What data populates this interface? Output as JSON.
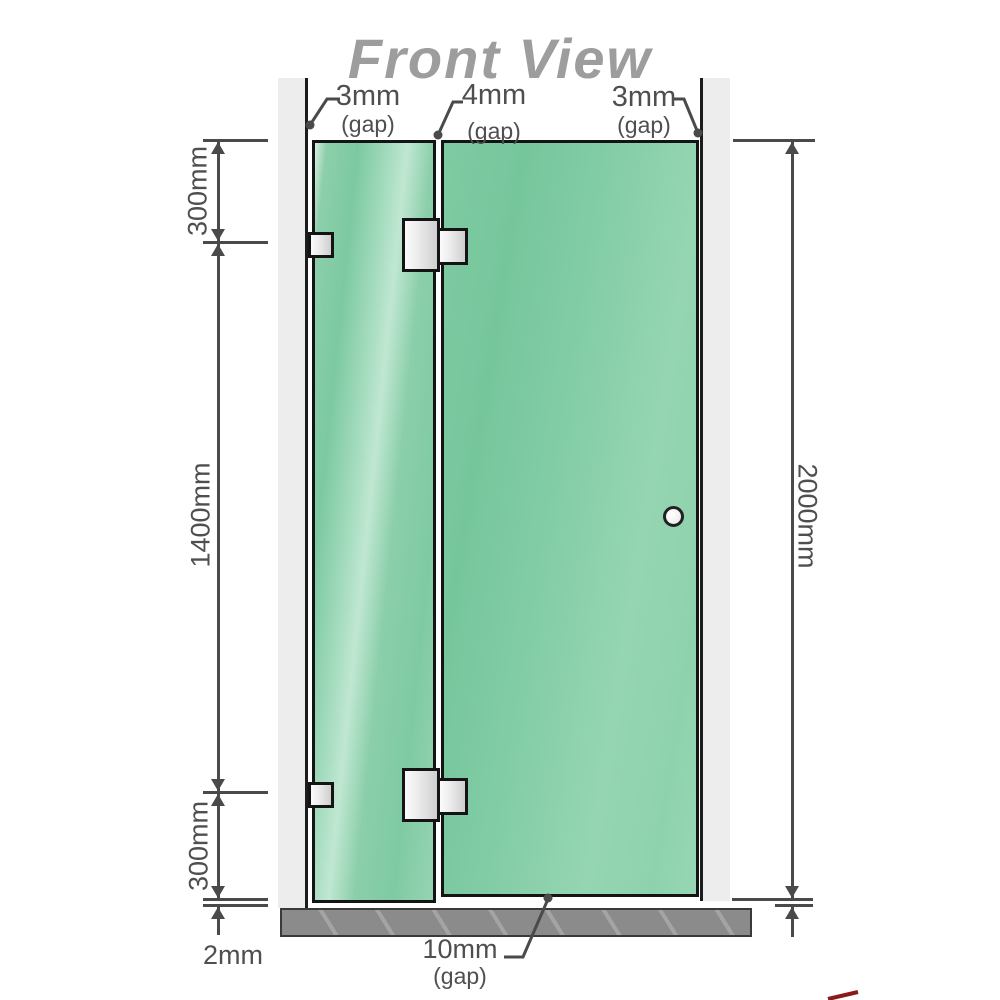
{
  "title": "Front View",
  "labels": {
    "gap_top_left": {
      "value": "3mm",
      "unit": "(gap)"
    },
    "gap_top_mid": {
      "value": "4mm",
      "unit": "(gap)"
    },
    "gap_top_right": {
      "value": "3mm",
      "unit": "(gap)"
    },
    "gap_bottom": {
      "value": "10mm",
      "unit": "(gap)"
    }
  },
  "dimensions": {
    "top_section": "300mm",
    "middle_section": "1400mm",
    "bottom_section": "300mm",
    "floor_clearance": "2mm",
    "overall_height": "2000mm"
  },
  "colors": {
    "glass_green": "#85cda8",
    "glass_highlight": "#c0e7d2",
    "wall_gray": "#ededed",
    "floor_gray": "#8b8b8b",
    "dimension_gray": "#4a4a4a",
    "title_gray": "#9d9d9d",
    "outline_black": "#141414",
    "hardware_metal": "#e8e8e8"
  },
  "diagram": {
    "type": "shower-screen-front-elevation",
    "panels": [
      {
        "name": "fixed-panel",
        "hardware": [
          "wall-bracket-top",
          "wall-bracket-bottom"
        ]
      },
      {
        "name": "door-panel",
        "hardware": [
          "hinge-top",
          "hinge-bottom",
          "round-knob"
        ]
      }
    ]
  }
}
